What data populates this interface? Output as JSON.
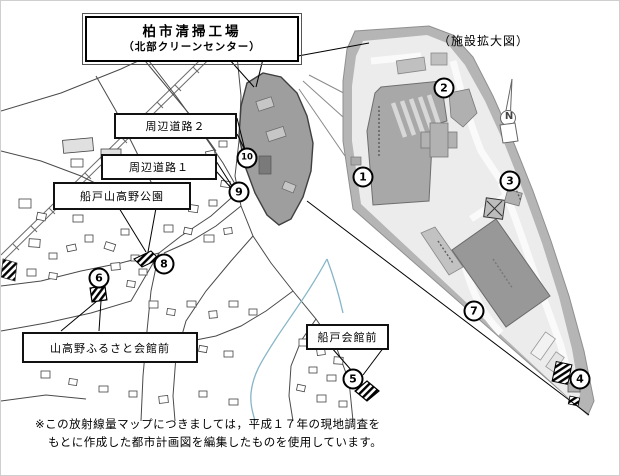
{
  "title_box": {
    "name": "柏市清掃工場",
    "subname": "（北部クリーンセンター）"
  },
  "enlarged_view_label": "（施設拡大図）",
  "location_labels": {
    "road2": "周辺道路２",
    "road1": "周辺道路１",
    "park": "船戸山高野公園",
    "yamakoya_hall": "山高野ふるさと会館前",
    "funado_hall": "船戸会館前"
  },
  "compass": {
    "north_label": "N"
  },
  "measurement_points": [
    {
      "id": 1,
      "label": "1",
      "x": 362,
      "y": 176
    },
    {
      "id": 2,
      "label": "2",
      "x": 443,
      "y": 87
    },
    {
      "id": 3,
      "label": "3",
      "x": 509,
      "y": 180
    },
    {
      "id": 4,
      "label": "4",
      "x": 579,
      "y": 378
    },
    {
      "id": 5,
      "label": "5",
      "x": 352,
      "y": 378
    },
    {
      "id": 6,
      "label": "6",
      "x": 98,
      "y": 277
    },
    {
      "id": 7,
      "label": "7",
      "x": 473,
      "y": 310
    },
    {
      "id": 8,
      "label": "8",
      "x": 163,
      "y": 263
    },
    {
      "id": 9,
      "label": "9",
      "x": 238,
      "y": 191
    },
    {
      "id": 10,
      "label": "10",
      "x": 246,
      "y": 157
    }
  ],
  "footnote": {
    "line1": "※この放射線量マップにつきましては，平成１７年の現地調査を",
    "line2": "もとに作成した都市計画図を編集したものを使用しています。"
  },
  "colors": {
    "site_band": "#b5b5b5",
    "site_inner": "#ececec",
    "building": "#a8a8a8",
    "building_dark": "#989898",
    "facility_fill": "#9e9e9e",
    "stream": "#86b5c6",
    "road_line": "#4a4a4a"
  }
}
